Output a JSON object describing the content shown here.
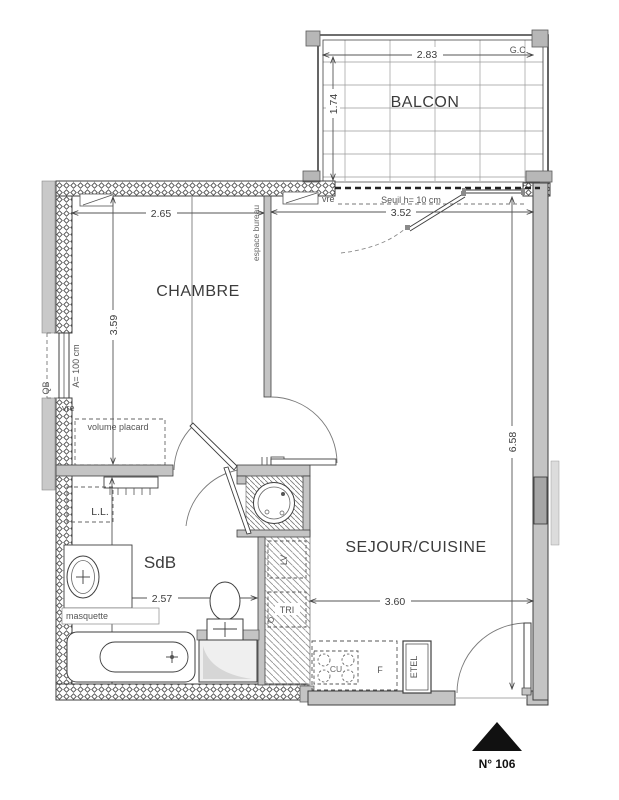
{
  "balcony": {
    "label": "BALCON",
    "corner_label": "G.C.",
    "dim_width": "2.83",
    "dim_depth": "1.74"
  },
  "bay_door": {
    "threshold_note": "Seuil h= 10 cm",
    "dim_width": "3.52"
  },
  "chambre": {
    "label": "CHAMBRE",
    "dim_width": "2.65",
    "dim_height": "3.59",
    "desk_note": "espace bureau",
    "closet_note": "volume placard",
    "shutter_top_label": "vre",
    "shutter_left_label": "vre",
    "window_note": "A= 100 cm",
    "window_code": "QB"
  },
  "sdb": {
    "label": "SdB",
    "dim_width": "2.57",
    "dim_height": "2.77",
    "washer_label": "L.L.",
    "vanity_label": "masquette"
  },
  "sejour": {
    "label": "SEJOUR/CUISINE",
    "dim_width": "3.60",
    "dim_height": "6.58",
    "sort_label": "TRI",
    "appliance_label": "LV",
    "cooktop_label": "CU",
    "fridge_label": "F",
    "tall_unit_label": "ETEL"
  },
  "entry": {
    "unit_number": "N° 106"
  },
  "colors": {
    "wall_fill": "#c4c4c4",
    "neighbor_fill": "#c9c9c9",
    "window_fill": "#a6a6a6",
    "line": "#3f3f3f",
    "hatch": "#666666"
  }
}
